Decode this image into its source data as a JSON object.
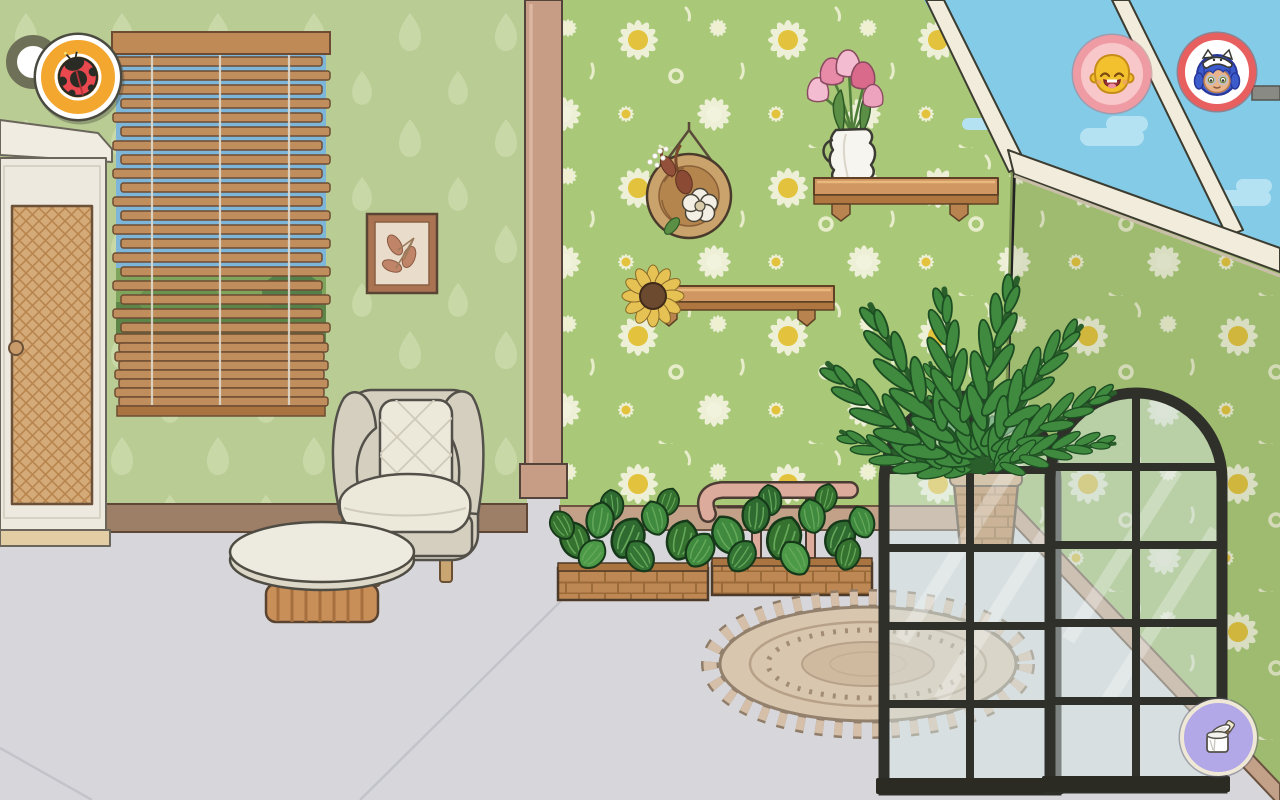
{
  "hud": {
    "top_left": [
      {
        "name": "home-button",
        "icon": "ring-dot-icon",
        "aria": "home"
      },
      {
        "name": "character-ladybug-button",
        "icon": "ladybug-icon",
        "aria": "ladybug character slot"
      }
    ],
    "top_right": [
      {
        "name": "character-yellow-button",
        "icon": "smiling-face-icon",
        "aria": "smiling yellow character slot"
      },
      {
        "name": "character-blue-button",
        "icon": "cat-hat-character-icon",
        "aria": "blue haired character with cat hat slot"
      }
    ],
    "bottom_right": [
      {
        "name": "paint-tool-button",
        "icon": "paint-can-brush-icon",
        "aria": "wall and floor decoration tool"
      }
    ]
  },
  "scene": {
    "objects": [
      "wardrobe",
      "window-with-bamboo-blinds",
      "framed-leaf-picture",
      "hanging-flower-basket",
      "wall-shelf-with-tulip-vase",
      "wall-shelf-with-sunflower",
      "pink-railing",
      "potted-fern",
      "planter-box-left",
      "planter-box-right",
      "round-woven-rug",
      "wingback-armchair",
      "round-coffee-table",
      "arched-window-panel-left",
      "arched-window-panel-right",
      "skylight"
    ]
  },
  "colors": {
    "sky": "#84cbe8",
    "cloud": "#b5e2f2",
    "floor": "#d7d7db",
    "wall_daisy_bg": "#a9c878",
    "wall_leaf_bg": "#b9cc93",
    "daisy_petal": "#edf0d6",
    "daisy_center": "#e3c33d",
    "skylight_beam": "#f2ecdc",
    "window_frame": "#30302a",
    "wood_shelf": "#d09763",
    "wicker": "#bd8854",
    "baseboard": "#9d7e66",
    "corner_post": "#c89d86",
    "railing": "#dcab9c",
    "armchair_body": "#d5cfc0",
    "armchair_cushion": "#ece8da",
    "ladybug_button_bg": "#f4a72e",
    "avatar1_ring": "#ee9ba4",
    "avatar1_bg": "#f8c7ca",
    "avatar2_ring": "#e7605f",
    "paint_button_bg": "#b2a7e7",
    "paint_button_ring": "#efe8d6"
  }
}
